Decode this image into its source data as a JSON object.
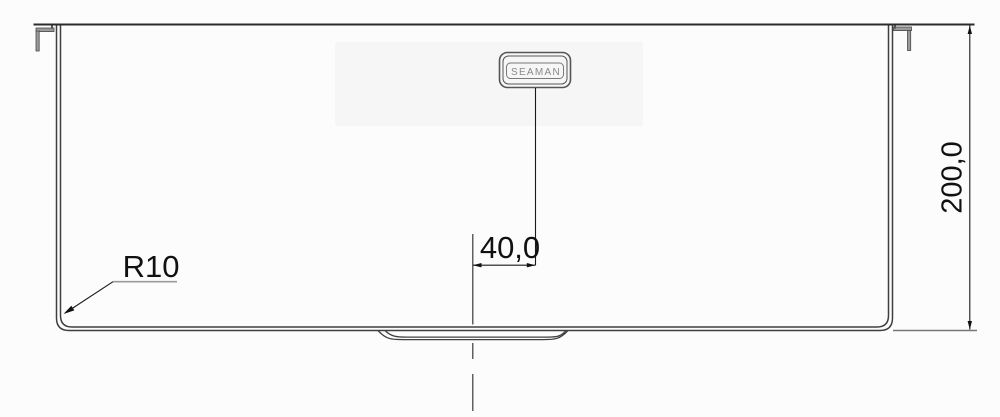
{
  "meta": {
    "title": "Sink front elevation technical drawing",
    "view": "front view with mounting clips and drain recess"
  },
  "badge": {
    "label": "SEAMAN"
  },
  "dimensions": {
    "offset": {
      "label": "40,0"
    },
    "height": {
      "label": "200,0"
    },
    "radius": {
      "label": "R10"
    }
  },
  "colors": {
    "background": "#fcfcfc",
    "outline": "#3f3f3f",
    "rim": "#2b2b2b",
    "dimension_text": "#111111",
    "leader_shoulder": "#9a9a9a",
    "clip_fill": "#9a9a9a",
    "badge_border": "#555555",
    "badge_text": "#8a8a8a"
  }
}
